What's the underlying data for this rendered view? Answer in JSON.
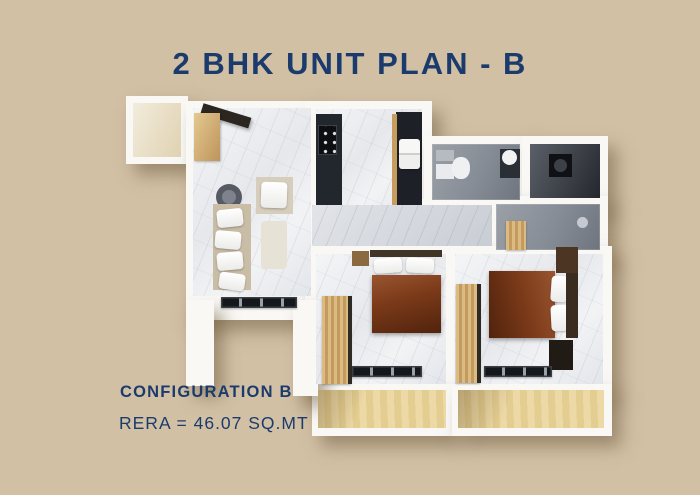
{
  "page": {
    "bg": "#d2c0a5",
    "accent": "#1c3b6d"
  },
  "title": "2 BHK UNIT PLAN - B",
  "footer": {
    "config": "CONFIGURATION B",
    "rera": "RERA = 46.07 SQ.MT"
  },
  "floorplan": {
    "palette": {
      "wall": "#f9f8f5",
      "dark_counter": "#22262d",
      "bed_blanket": "#7c3b1a",
      "wood": "#c49b5f",
      "balcony_wood": "#e8d49c",
      "bath_tile": "#868c95"
    },
    "shapes": [
      {
        "n": "lobby-walls",
        "x": 126,
        "y": 96,
        "w": 62,
        "h": 68,
        "cls": "wall shadowed"
      },
      {
        "n": "living-room-walls",
        "x": 186,
        "y": 101,
        "w": 132,
        "h": 219,
        "cls": "wall shadowed"
      },
      {
        "n": "kitchen-walls",
        "x": 305,
        "y": 101,
        "w": 127,
        "h": 110,
        "cls": "wall shadowed"
      },
      {
        "n": "bathroom1-walls",
        "x": 424,
        "y": 136,
        "w": 104,
        "h": 74,
        "cls": "wall shadowed"
      },
      {
        "n": "utility-room-walls",
        "x": 522,
        "y": 136,
        "w": 86,
        "h": 70,
        "cls": "wall shadowed"
      },
      {
        "n": "shower-room-walls",
        "x": 488,
        "y": 196,
        "w": 120,
        "h": 62,
        "cls": "wall shadowed"
      },
      {
        "n": "passage-walls",
        "x": 305,
        "y": 199,
        "w": 195,
        "h": 57,
        "cls": "wall"
      },
      {
        "n": "bedrooms-walls",
        "x": 305,
        "y": 246,
        "w": 307,
        "h": 146,
        "cls": "wall shadowed"
      },
      {
        "n": "balcony1-walls",
        "x": 312,
        "y": 384,
        "w": 140,
        "h": 52,
        "cls": "wall shadowed"
      },
      {
        "n": "balcony2-walls",
        "x": 452,
        "y": 384,
        "w": 160,
        "h": 52,
        "cls": "wall shadowed"
      },
      {
        "n": "left-wall-column",
        "x": 186,
        "y": 300,
        "w": 28,
        "h": 86,
        "cls": "wall shadowed"
      },
      {
        "n": "right-wall-column",
        "x": 293,
        "y": 300,
        "w": 25,
        "h": 96,
        "cls": "wall shadowed"
      },
      {
        "n": "lobby-floor",
        "x": 133,
        "y": 103,
        "w": 48,
        "h": 54,
        "cls": "cream"
      },
      {
        "n": "living-room-floor",
        "x": 193,
        "y": 108,
        "w": 118,
        "h": 188,
        "cls": "marble"
      },
      {
        "n": "kitchen-floor",
        "x": 316,
        "y": 109,
        "w": 106,
        "h": 96,
        "cls": "marble"
      },
      {
        "n": "bathroom1-floor",
        "x": 432,
        "y": 144,
        "w": 88,
        "h": 56,
        "cls": "tile"
      },
      {
        "n": "utility-room-floor",
        "x": 530,
        "y": 144,
        "w": 70,
        "h": 54,
        "cls": "tile-dark"
      },
      {
        "n": "shower-room-floor",
        "x": 496,
        "y": 204,
        "w": 104,
        "h": 46,
        "cls": "tile"
      },
      {
        "n": "passage-floor",
        "x": 312,
        "y": 205,
        "w": 180,
        "h": 41,
        "cls": "marble-gray"
      },
      {
        "n": "bedroom1-floor",
        "x": 316,
        "y": 254,
        "w": 130,
        "h": 130,
        "cls": "marble"
      },
      {
        "n": "bedroom2-floor",
        "x": 455,
        "y": 254,
        "w": 148,
        "h": 130,
        "cls": "marble"
      },
      {
        "n": "balcony1-floor",
        "x": 318,
        "y": 390,
        "w": 128,
        "h": 38,
        "cls": "wood-floor"
      },
      {
        "n": "balcony2-floor",
        "x": 458,
        "y": 390,
        "w": 146,
        "h": 38,
        "cls": "wood-floor"
      },
      {
        "n": "entry-door",
        "x": 202,
        "y": 103,
        "w": 50,
        "h": 11,
        "c": "#2b2620",
        "r": 17,
        "cls": "door"
      },
      {
        "n": "entry-shoe-cabinet",
        "x": 194,
        "y": 113,
        "w": 26,
        "h": 48,
        "cls": "wood-soft"
      },
      {
        "n": "pouf",
        "x": 216,
        "y": 184,
        "w": 26,
        "h": 26,
        "c": "#565a62",
        "rad": "50%"
      },
      {
        "n": "pouf-top",
        "x": 222,
        "y": 190,
        "w": 14,
        "h": 14,
        "c": "#7d828c",
        "rad": "50%"
      },
      {
        "n": "sofa-base",
        "x": 213,
        "y": 204,
        "w": 38,
        "h": 86,
        "c": "#c9bda6"
      },
      {
        "n": "sofa-cushion",
        "x": 217,
        "y": 209,
        "w": 26,
        "h": 18,
        "cls": "pillow",
        "r": -6
      },
      {
        "n": "sofa-cushion",
        "x": 215,
        "y": 231,
        "w": 26,
        "h": 18,
        "cls": "pillow",
        "r": 5
      },
      {
        "n": "sofa-cushion",
        "x": 217,
        "y": 252,
        "w": 26,
        "h": 18,
        "cls": "pillow",
        "r": -5
      },
      {
        "n": "sofa-cushion",
        "x": 219,
        "y": 273,
        "w": 26,
        "h": 17,
        "cls": "pillow",
        "r": 8
      },
      {
        "n": "armchair",
        "x": 256,
        "y": 177,
        "w": 37,
        "h": 37,
        "c": "#d6cdbd"
      },
      {
        "n": "armchair-cushion",
        "x": 261,
        "y": 182,
        "w": 26,
        "h": 26,
        "cls": "pillow",
        "r": 2
      },
      {
        "n": "lounge-chair",
        "x": 261,
        "y": 221,
        "w": 26,
        "h": 48,
        "c": "#e7e2d6",
        "rad": "4px"
      },
      {
        "n": "living-window",
        "x": 221,
        "y": 297,
        "w": 76,
        "h": 11,
        "cls": "window"
      },
      {
        "n": "kitchen-counter-left",
        "x": 316,
        "y": 114,
        "w": 26,
        "h": 91,
        "c": "#22262d"
      },
      {
        "n": "stove",
        "x": 318,
        "y": 125,
        "w": 19,
        "h": 30,
        "cls": "burners"
      },
      {
        "n": "kitchen-counter-right",
        "x": 396,
        "y": 112,
        "w": 26,
        "h": 93,
        "c": "#1d2127"
      },
      {
        "n": "kitchen-tall-cabinet",
        "x": 392,
        "y": 114,
        "w": 5,
        "h": 91,
        "c": "#c79c5f"
      },
      {
        "n": "fridge",
        "x": 399,
        "y": 139,
        "w": 21,
        "h": 30,
        "cls": "fridge"
      },
      {
        "n": "toilet-tank",
        "x": 436,
        "y": 150,
        "w": 18,
        "h": 11,
        "c": "#b6bbc2"
      },
      {
        "n": "bath-mat",
        "x": 436,
        "y": 164,
        "w": 18,
        "h": 15,
        "c": "#e9ebee"
      },
      {
        "n": "toilet-bowl",
        "x": 452,
        "y": 157,
        "w": 18,
        "h": 22,
        "c": "#eef0f2",
        "rad": "45%"
      },
      {
        "n": "vanity-counter",
        "x": 500,
        "y": 149,
        "w": 20,
        "h": 29,
        "c": "#2a2e35"
      },
      {
        "n": "wash-basin",
        "x": 502,
        "y": 150,
        "w": 15,
        "h": 15,
        "c": "#f1f2f4",
        "rad": "50%"
      },
      {
        "n": "washing-machine",
        "x": 549,
        "y": 154,
        "w": 23,
        "h": 23,
        "c": "#0f1114"
      },
      {
        "n": "washing-machine-door",
        "x": 554,
        "y": 159,
        "w": 13,
        "h": 13,
        "c": "#3c4148",
        "rad": "50%"
      },
      {
        "n": "shower-stool",
        "x": 506,
        "y": 221,
        "w": 20,
        "h": 29,
        "cls": "wood"
      },
      {
        "n": "shower-mixer",
        "x": 577,
        "y": 217,
        "w": 11,
        "h": 11,
        "c": "#c6cad0",
        "rad": "50%"
      },
      {
        "n": "nightstand",
        "x": 352,
        "y": 251,
        "w": 17,
        "h": 15,
        "c": "#8a6a3e"
      },
      {
        "n": "bed1-headboard",
        "x": 370,
        "y": 250,
        "w": 72,
        "h": 7,
        "c": "#403526"
      },
      {
        "n": "bed1-pillow",
        "x": 374,
        "y": 258,
        "w": 28,
        "h": 15,
        "cls": "pillow",
        "r": -4
      },
      {
        "n": "bed1-pillow",
        "x": 406,
        "y": 258,
        "w": 28,
        "h": 15,
        "cls": "pillow",
        "r": 3
      },
      {
        "n": "bed1-blanket",
        "x": 372,
        "y": 275,
        "w": 69,
        "h": 58,
        "cls": "blanket"
      },
      {
        "n": "wardrobe1",
        "x": 322,
        "y": 296,
        "w": 29,
        "h": 88,
        "cls": "wood"
      },
      {
        "n": "wardrobe1-edge",
        "x": 348,
        "y": 296,
        "w": 4,
        "h": 88,
        "c": "#2e2a24"
      },
      {
        "n": "bedroom1-window",
        "x": 352,
        "y": 366,
        "w": 70,
        "h": 11,
        "cls": "window"
      },
      {
        "n": "wardrobe2",
        "x": 456,
        "y": 284,
        "w": 24,
        "h": 99,
        "cls": "wood"
      },
      {
        "n": "wardrobe2-edge",
        "x": 477,
        "y": 284,
        "w": 4,
        "h": 99,
        "c": "#2e2a24"
      },
      {
        "n": "bed2-blanket",
        "x": 489,
        "y": 271,
        "w": 66,
        "h": 67,
        "cls": "blanket2"
      },
      {
        "n": "bed2-pillow",
        "x": 551,
        "y": 276,
        "w": 17,
        "h": 26,
        "cls": "pillow",
        "r": 4
      },
      {
        "n": "bed2-pillow",
        "x": 551,
        "y": 305,
        "w": 17,
        "h": 26,
        "cls": "pillow",
        "r": -3
      },
      {
        "n": "bed2-headboard",
        "x": 566,
        "y": 271,
        "w": 12,
        "h": 67,
        "c": "#3a2d20"
      },
      {
        "n": "bed2-post",
        "x": 556,
        "y": 247,
        "w": 22,
        "h": 26,
        "c": "#4c3623"
      },
      {
        "n": "nightstand",
        "x": 549,
        "y": 340,
        "w": 24,
        "h": 30,
        "c": "#211b16"
      },
      {
        "n": "bedroom2-window",
        "x": 484,
        "y": 366,
        "w": 68,
        "h": 11,
        "cls": "window"
      }
    ]
  }
}
